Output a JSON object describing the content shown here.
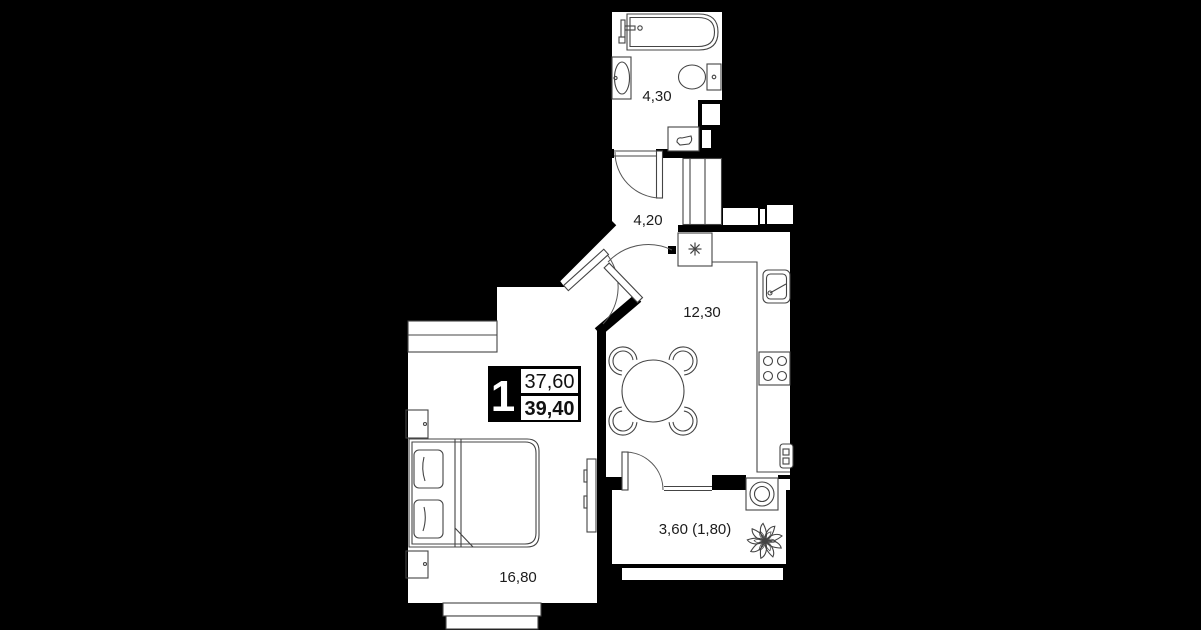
{
  "colors": {
    "background": "#000000",
    "floor": "#ffffff",
    "furniture_line": "#444444",
    "label_text": "#1c1c1c"
  },
  "rooms": [
    {
      "name": "bathroom",
      "area": "4,30"
    },
    {
      "name": "hallway",
      "area": "4,20"
    },
    {
      "name": "kitchen",
      "area": "12,30"
    },
    {
      "name": "bedroom",
      "area": "16,80"
    },
    {
      "name": "balcony",
      "area": "3,60 (1,80)"
    }
  ],
  "badge": {
    "room_count": "1",
    "area_top": "37,60",
    "area_bottom": "39,40"
  }
}
